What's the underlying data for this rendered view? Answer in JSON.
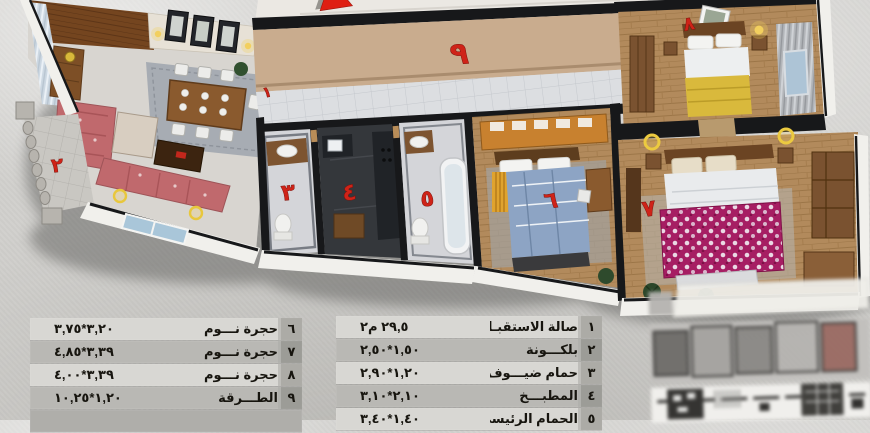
{
  "plan": {
    "numerals": [
      "١",
      "٢",
      "٣",
      "٤",
      "٥",
      "٦",
      "٧",
      "٨",
      "٩"
    ],
    "colors": {
      "numeral_red": "#cf2318",
      "arrow_red": "#df1f13",
      "corridor_wall_tan": "#c9ac8e",
      "background_gray": "#d1d0cd",
      "bed6_blue": "#8da4c4",
      "bed7_magenta": "#a61e63",
      "bed8_yellow": "#d9b93c",
      "sofa_rose": "#c0696d"
    }
  },
  "legend": {
    "right": {
      "rows": [
        {
          "no": "١",
          "name": "صالة الاستقبـال",
          "dim": "٢٩,٥ م٢"
        },
        {
          "no": "٢",
          "name": "بلكـــونة",
          "dim": "٢,٥٠‎*‎١,٥٠"
        },
        {
          "no": "٣",
          "name": "حمام ضيـــوف",
          "dim": "٢,٩٠‎*‎١,٢٠"
        },
        {
          "no": "٤",
          "name": "المطبـــخ",
          "dim": "٣,١٠‎*‎٢,١٠"
        },
        {
          "no": "٥",
          "name": "الحمام الرئيسي",
          "dim": "٣,٤٠‎*‎١,٤٠"
        }
      ]
    },
    "left": {
      "rows": [
        {
          "no": "٦",
          "name": "حجرة نـــوم",
          "dim": "٣,٧٥‎*‎٣,٢٠"
        },
        {
          "no": "٧",
          "name": "حجرة نـــوم",
          "dim": "٤,٨٥‎*‎٣,٣٩"
        },
        {
          "no": "٨",
          "name": "حجرة نـــوم",
          "dim": "٤,٠٠‎*‎٣,٣٩"
        },
        {
          "no": "٩",
          "name": "الطـــرقة",
          "dim": "١٠,٢٥‎*‎١,٢٠"
        }
      ]
    }
  }
}
